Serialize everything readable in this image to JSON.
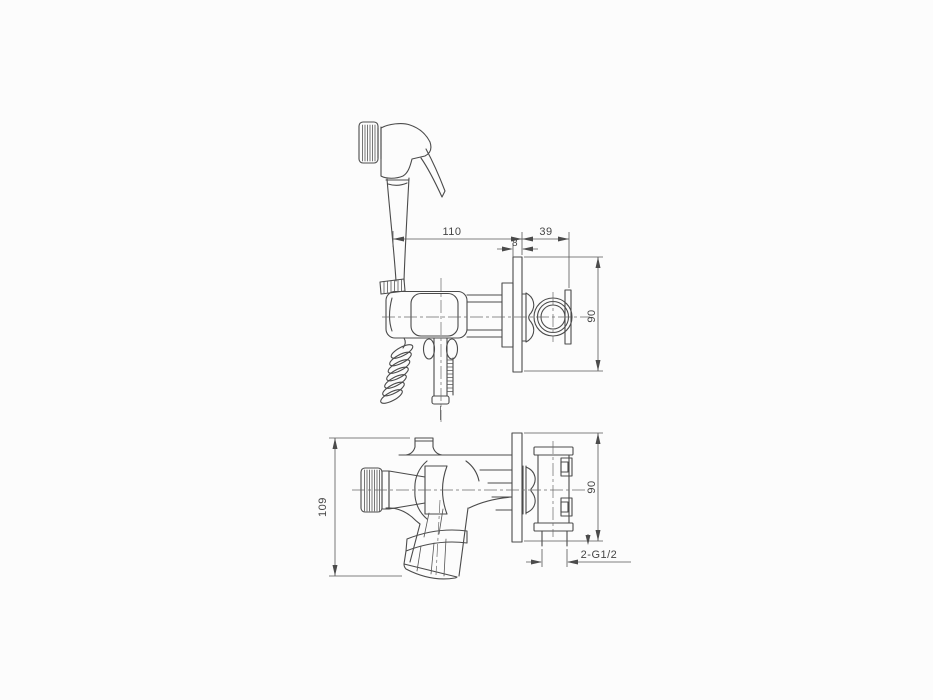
{
  "drawing": {
    "kind": "technical-drawing",
    "colors": {
      "background": "#fcfcfc",
      "object_line": "#4b4b4b",
      "dimension_line": "#585858"
    },
    "side_view": {
      "dim_wall_to_axis": "110",
      "dim_depth_behind_wall": "39",
      "dim_plate_thickness": "8",
      "dim_plate_height": "90"
    },
    "front_view": {
      "dim_overall_height": "109",
      "dim_plate_height": "90",
      "dim_thread": "2-G1/2"
    }
  }
}
